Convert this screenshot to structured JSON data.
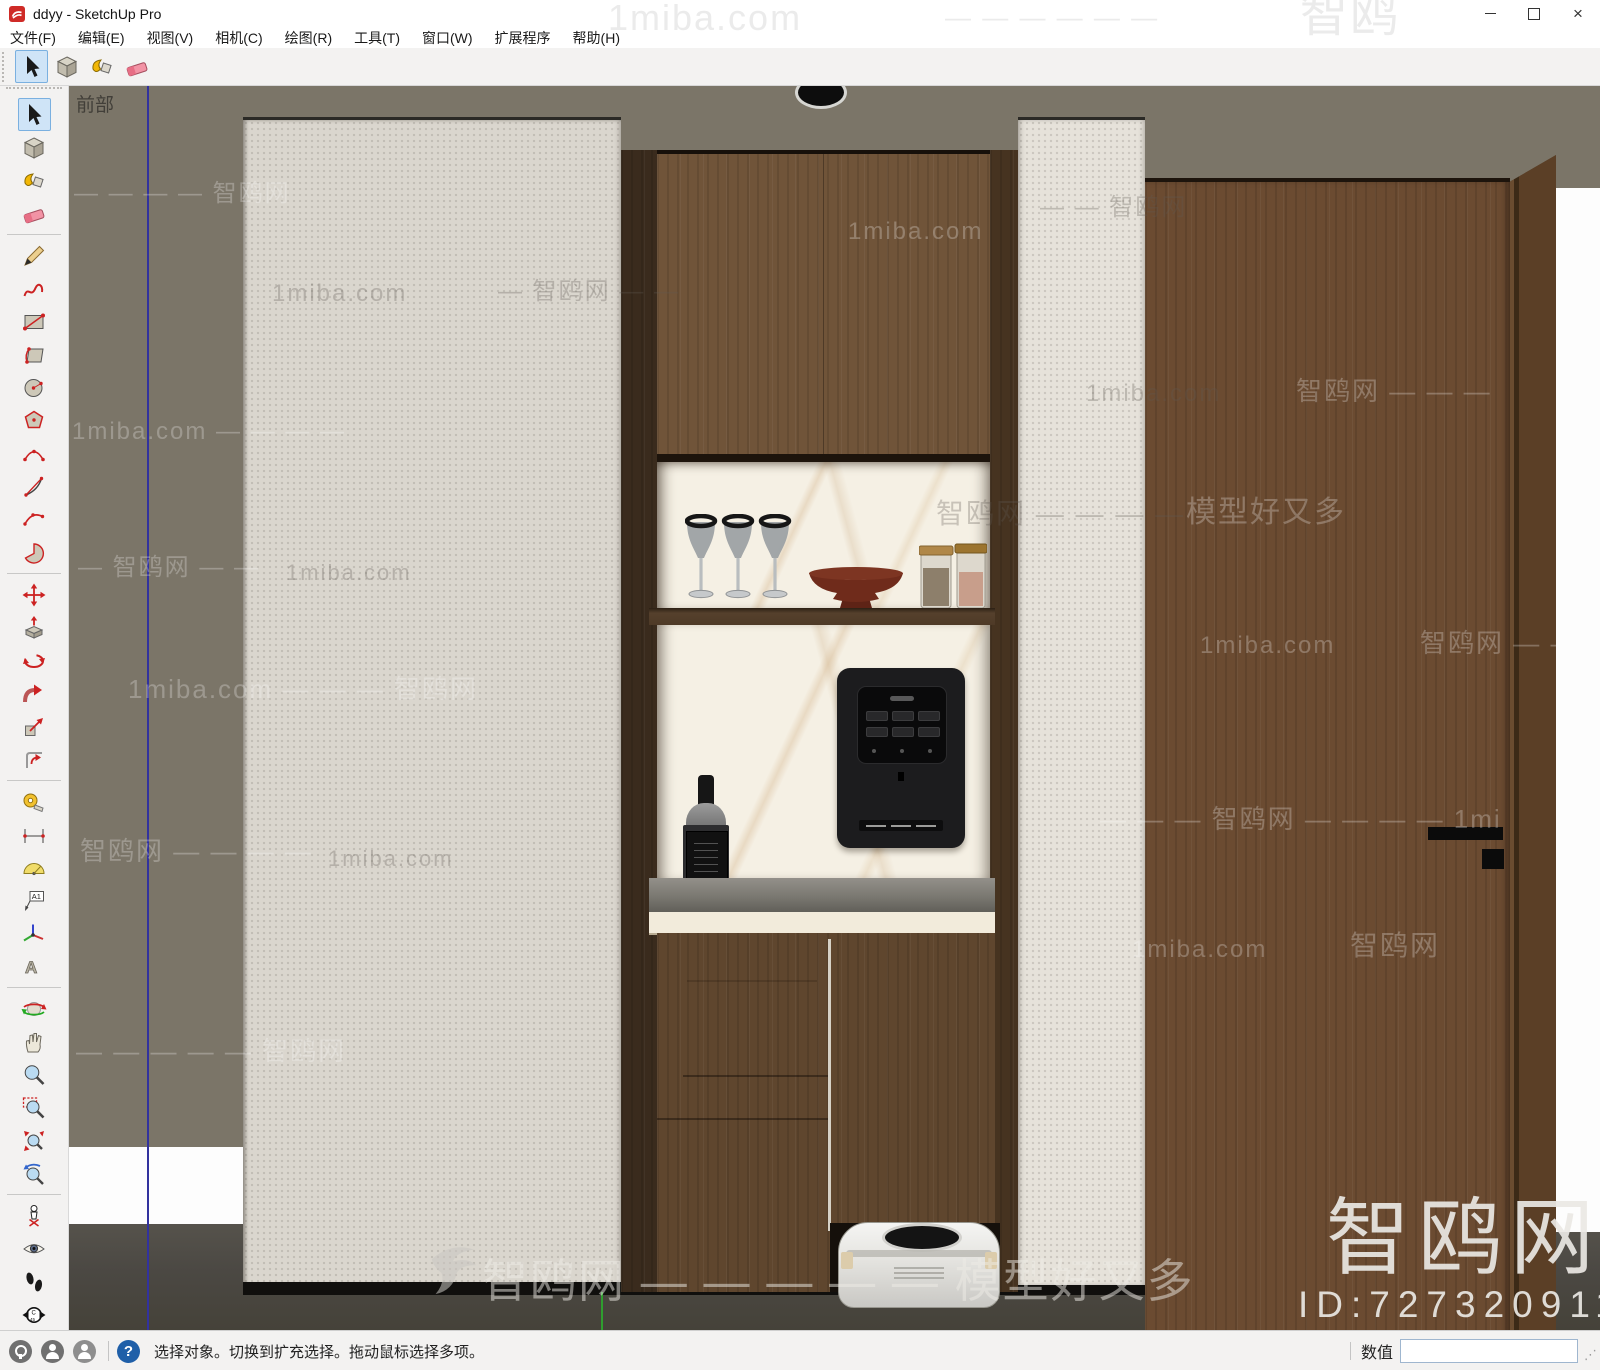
{
  "window": {
    "title": "ddyy - SketchUp Pro",
    "controls": {
      "minimize": "minimize",
      "maximize": "maximize",
      "close": "close"
    }
  },
  "menu_bar": {
    "items": [
      "文件(F)",
      "编辑(E)",
      "视图(V)",
      "相机(C)",
      "绘图(R)",
      "工具(T)",
      "窗口(W)",
      "扩展程序",
      "帮助(H)"
    ]
  },
  "top_toolbar": {
    "active_tool": "select",
    "tools": [
      "select",
      "make-component",
      "paint-bucket",
      "eraser"
    ]
  },
  "left_toolbar": {
    "active_tool": "select",
    "groups": [
      [
        "select",
        "make-component",
        "paint-bucket",
        "eraser"
      ],
      [
        "line",
        "freehand",
        "rectangle",
        "rotated-rectangle",
        "circle",
        "polygon",
        "two-point-arc",
        "arc",
        "three-point-arc",
        "pie"
      ],
      [
        "move",
        "push-pull",
        "rotate",
        "follow-me",
        "scale",
        "offset"
      ],
      [
        "tape-measure",
        "dimension",
        "protractor",
        "text",
        "axes",
        "3d-text"
      ],
      [
        "orbit",
        "pan",
        "zoom",
        "zoom-window",
        "zoom-extents",
        "zoom-previous"
      ],
      [
        "position-camera",
        "look-around",
        "walk",
        "compass"
      ]
    ]
  },
  "viewport": {
    "view_label": "前部",
    "scene_objects": [
      "wall",
      "floor",
      "stone-panel",
      "wine-cabinet",
      "wine-glasses",
      "pedestal-bowl",
      "storage-jars",
      "whiskey-bottle",
      "water-dispenser",
      "marble-pillar",
      "lower-cabinet",
      "robot-vacuum",
      "wood-door",
      "open-door-leaf",
      "ceiling-downlight"
    ],
    "palette": {
      "wall": "#7b7568",
      "floor": "#4b4843",
      "stone_panel": "#dad6ce",
      "pillar": "#e6e2da",
      "cabinet_wood": "#705439",
      "dark_wood": "#3a2b1d",
      "marble": "#f5f0e4",
      "counter_marble": "#f2ebdb",
      "door_wood": "#6b4b31",
      "dispenser": "#1c1c1e",
      "bowl_red": "#6f2b1b",
      "axis_blue": "#32329e",
      "axis_green": "#2f9e2f",
      "select_highlight": "#cfe4f7",
      "help_blue": "#1f5fa8"
    }
  },
  "watermarks": [
    {
      "text": "1miba.com",
      "x": 608,
      "y": 0,
      "size": 36,
      "tone": "paper"
    },
    {
      "text": "— — — — — —",
      "x": 945,
      "y": 4,
      "size": 26,
      "tone": "paper"
    },
    {
      "text": "智鸥",
      "x": 1300,
      "y": -8,
      "size": 48,
      "tone": "paper"
    },
    {
      "text": "— — — — 智鸥网",
      "x": 74,
      "y": 182,
      "size": 24,
      "tone": "light"
    },
    {
      "text": "1miba.com",
      "x": 272,
      "y": 282,
      "size": 24,
      "tone": "dark"
    },
    {
      "text": "— 智鸥网 — —",
      "x": 498,
      "y": 280,
      "size": 24,
      "tone": "dark"
    },
    {
      "text": "1miba.com",
      "x": 848,
      "y": 220,
      "size": 24,
      "tone": "light"
    },
    {
      "text": "— — 智鸥网",
      "x": 1040,
      "y": 196,
      "size": 24,
      "tone": "dark"
    },
    {
      "text": "1miba.com",
      "x": 1086,
      "y": 382,
      "size": 24,
      "tone": "dark"
    },
    {
      "text": "智鸥网 — — —",
      "x": 1296,
      "y": 378,
      "size": 26,
      "tone": "light"
    },
    {
      "text": "1miba.com — — — —",
      "x": 72,
      "y": 420,
      "size": 24,
      "tone": "light"
    },
    {
      "text": "智鸥网 — — — —",
      "x": 936,
      "y": 500,
      "size": 28,
      "tone": "dark"
    },
    {
      "text": "模型好又多",
      "x": 1186,
      "y": 498,
      "size": 30,
      "tone": "light"
    },
    {
      "text": "— 智鸥网 — —",
      "x": 78,
      "y": 556,
      "size": 24,
      "tone": "light"
    },
    {
      "text": "1miba.com",
      "x": 286,
      "y": 562,
      "size": 22,
      "tone": "dark"
    },
    {
      "text": "1miba.com",
      "x": 1200,
      "y": 634,
      "size": 24,
      "tone": "light"
    },
    {
      "text": "智鸥网 — —",
      "x": 1420,
      "y": 630,
      "size": 26,
      "tone": "light"
    },
    {
      "text": "1miba.com — — — 智鸥网",
      "x": 128,
      "y": 676,
      "size": 26,
      "tone": "light"
    },
    {
      "text": "— — — 智鸥网 — — — — 1mi",
      "x": 1100,
      "y": 806,
      "size": 26,
      "tone": "light"
    },
    {
      "text": "智鸥网 — — — —",
      "x": 80,
      "y": 838,
      "size": 26,
      "tone": "light"
    },
    {
      "text": "1miba.com",
      "x": 328,
      "y": 848,
      "size": 22,
      "tone": "dark"
    },
    {
      "text": "1miba.com",
      "x": 1132,
      "y": 938,
      "size": 24,
      "tone": "light"
    },
    {
      "text": "智鸥网",
      "x": 1350,
      "y": 932,
      "size": 28,
      "tone": "light"
    },
    {
      "text": "— — — — — 智鸥网",
      "x": 76,
      "y": 1038,
      "size": 26,
      "tone": "light"
    },
    {
      "text": "智鸥网 — — — — — 模型好又多",
      "x": 482,
      "y": 1258,
      "size": 46,
      "tone": "brand"
    },
    {
      "text": "智鸥网",
      "x": 1326,
      "y": 1196,
      "size": 84,
      "tone": "strong"
    },
    {
      "text": "ID:727320911",
      "x": 1298,
      "y": 1286,
      "size": 37,
      "tone": "strong"
    }
  ],
  "status_bar": {
    "message": "选择对象。切换到扩充选择。拖动鼠标选择多项。",
    "measurements_label": "数值",
    "measurements_value": ""
  }
}
